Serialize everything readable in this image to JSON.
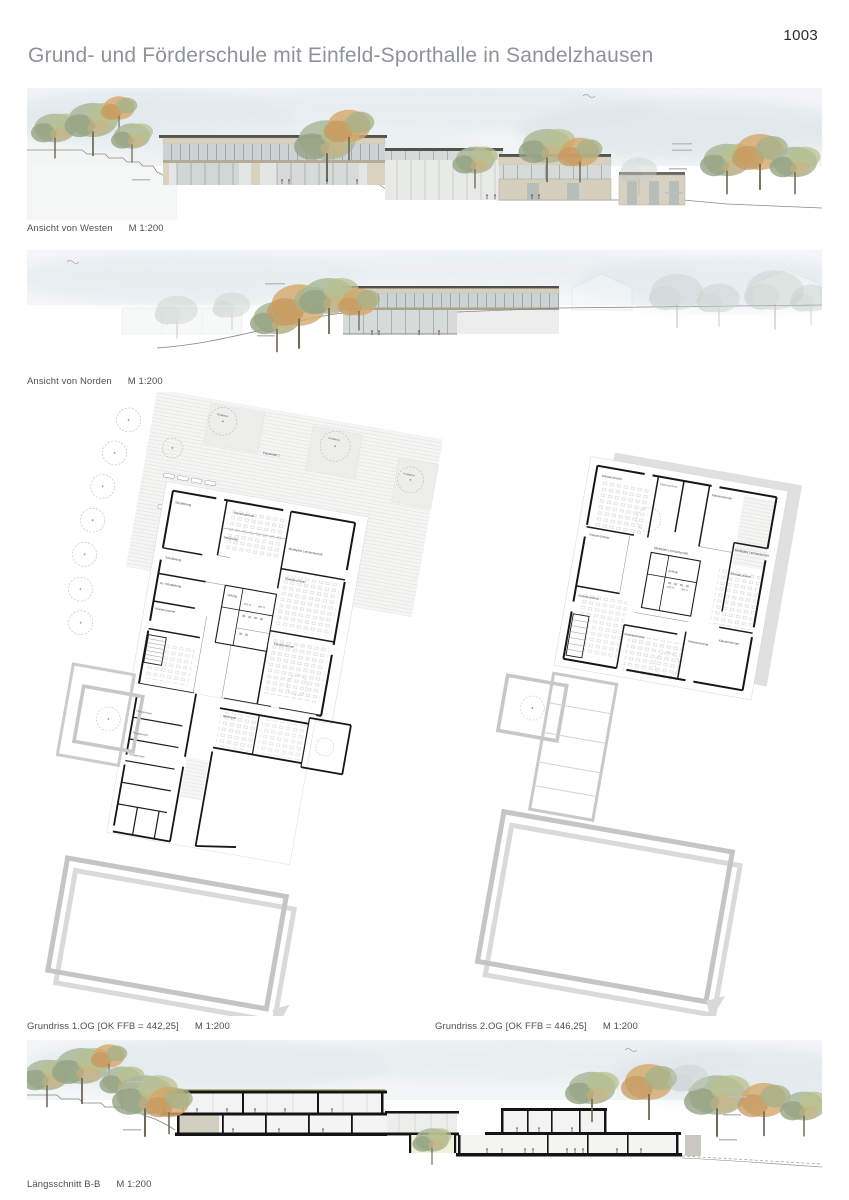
{
  "page": {
    "number": "1003",
    "title": "Grund- und Förderschule mit Einfeld-Sporthalle in Sandelzhausen"
  },
  "drawings": {
    "west": {
      "caption": "Ansicht von Westen",
      "scale": "M 1:200"
    },
    "north": {
      "caption": "Ansicht von Norden",
      "scale": "M 1:200"
    },
    "plan1": {
      "caption": "Grundriss 1.OG [OK FFB = 442,25]",
      "scale": "M 1:200",
      "room_labels": [
        "Pausenhof 2",
        "Freiklasse",
        "Freiklasse",
        "Freiklasse",
        "Klassenzimmer",
        "Marktplatz Lernlandschaft",
        "Schulleitung",
        "Schulleitung",
        "stv. Schulleitung",
        "Sekretariat",
        "Aufzug",
        "WC D",
        "WC H",
        "Klassenzimmer",
        "Klassenzimmer",
        "Klassenzimmer",
        "Werkraum",
        "Therapieraum",
        "Therapieraum",
        "Therapieraum"
      ]
    },
    "plan2": {
      "caption": "Grundriss 2.OG [OK FFB = 446,25]",
      "scale": "M 1:200",
      "room_labels": [
        "Klassenzimmer",
        "Klassenzimmer",
        "Klassenzimmer",
        "Klassenzimmer",
        "Marktplatz Lernlandschaft",
        "Marktplatz Lernlandschaft",
        "Aufzug",
        "WC D",
        "WC H",
        "Klassenzimmer",
        "Klassenzimmer",
        "Klassenzimmer",
        "Klassenzimmer",
        "Klassenzimmer"
      ]
    },
    "section": {
      "caption": "Längsschnitt B-B",
      "scale": "M 1:200"
    }
  },
  "colors": {
    "title_gray": "#8e9399",
    "caption_gray": "#4c4f52",
    "cut_black": "#141414",
    "ghost_gray": "#c7c7c7",
    "wood": "#d6cfbd",
    "glass": "#ccd3d3",
    "foliage_green": "#a8b596",
    "foliage_orange": "#d2a86e",
    "sky_wash": "#e2e9ec"
  }
}
